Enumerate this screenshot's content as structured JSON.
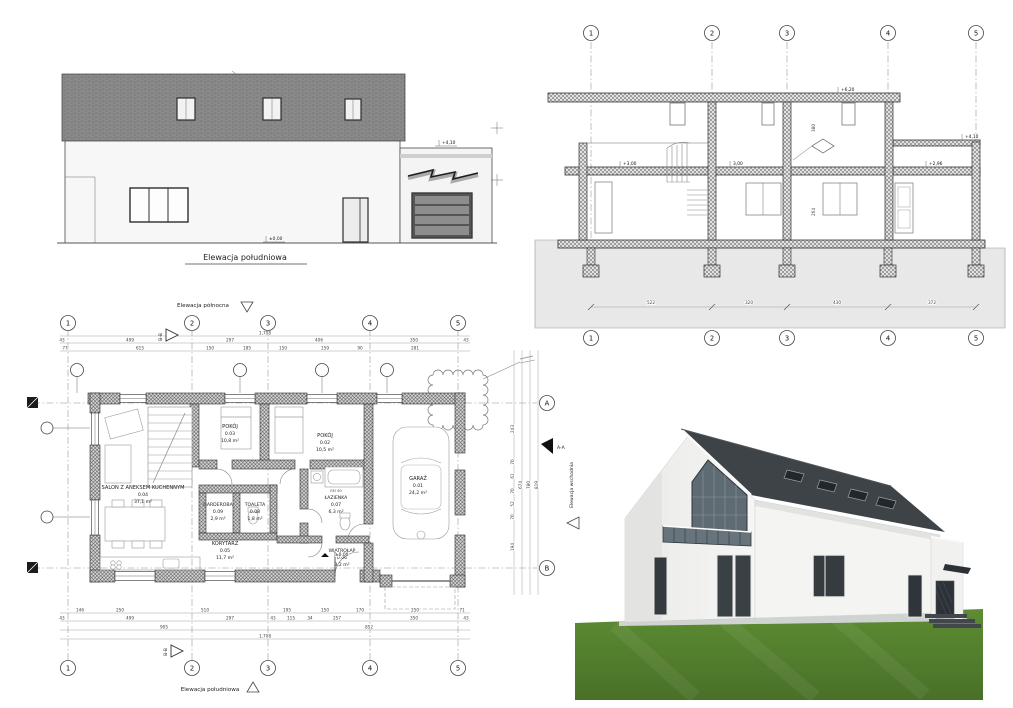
{
  "drawing": {
    "elevation_south": {
      "title": "Elewacja południowa",
      "level_top": "+4,10",
      "level_zero": "±0,00"
    },
    "section": {
      "grid": [
        "1",
        "2",
        "3",
        "4",
        "5"
      ],
      "level_roof": "+6,20",
      "level_floor_left": "+3,00",
      "level_floor_mid": "3,00",
      "level_annex_floor": "+2,96",
      "level_annex_roof": "+4,10",
      "dim_v_upper": "380",
      "dim_v_lower": "264",
      "dims_bottom": [
        "522",
        "320",
        "430",
        "372"
      ]
    },
    "plan": {
      "title_north": "Elewacja północna",
      "title_south": "Elewacja południowa",
      "title_east": "Elewacja wschodnia",
      "marker_bb": "B-B",
      "marker_aa": "A-A",
      "grid": [
        "1",
        "2",
        "3",
        "4",
        "5"
      ],
      "grid_rows": [
        "A",
        "B"
      ],
      "level_zero": "±0,00",
      "fire_label": "REI 60",
      "rooms": [
        {
          "name": "SALON Z ANEKSEM KUCHENNYM",
          "no": "0.04",
          "area": "37,1 m²"
        },
        {
          "name": "POKÓJ",
          "no": "0.03",
          "area": "10,8 m²"
        },
        {
          "name": "POKÓJ",
          "no": "0.02",
          "area": "10,5 m²"
        },
        {
          "name": "GARDEROBA",
          "no": "0.09",
          "area": "2,9 m²"
        },
        {
          "name": "TOALETA",
          "no": "0.08",
          "area": "1,8 m²"
        },
        {
          "name": "KORYTARZ",
          "no": "0.05",
          "area": "11,7 m²"
        },
        {
          "name": "ŁAZIENKA",
          "no": "0.07",
          "area": "6,3 m²"
        },
        {
          "name": "WIATROŁAP",
          "no": "0.06",
          "area": "3,2 m²"
        },
        {
          "name": "GARAŻ",
          "no": "0.01",
          "area": "24,2 m²"
        }
      ],
      "dims_top_total": "1,708",
      "dims_top_row2": [
        "43",
        "499",
        "297",
        "406",
        "350",
        "43"
      ],
      "dims_top_row3": [
        "77",
        "615",
        "150",
        "185",
        "150",
        "159",
        "90",
        "281"
      ],
      "dims_bottom_row1": [
        "146",
        "250",
        "510",
        "195",
        "150",
        "170",
        "250",
        "71"
      ],
      "dims_bottom_row2": [
        "43",
        "499",
        "297",
        "43",
        "115",
        "34",
        "257",
        "350",
        "43"
      ],
      "dims_bottom_row3": [
        "905",
        "852"
      ],
      "dims_bottom_total": "1,708",
      "dims_right": [
        "243",
        "70",
        "61",
        "70",
        "52",
        "70",
        "194"
      ],
      "dims_right_totals": [
        "674",
        "780",
        "819"
      ]
    }
  }
}
